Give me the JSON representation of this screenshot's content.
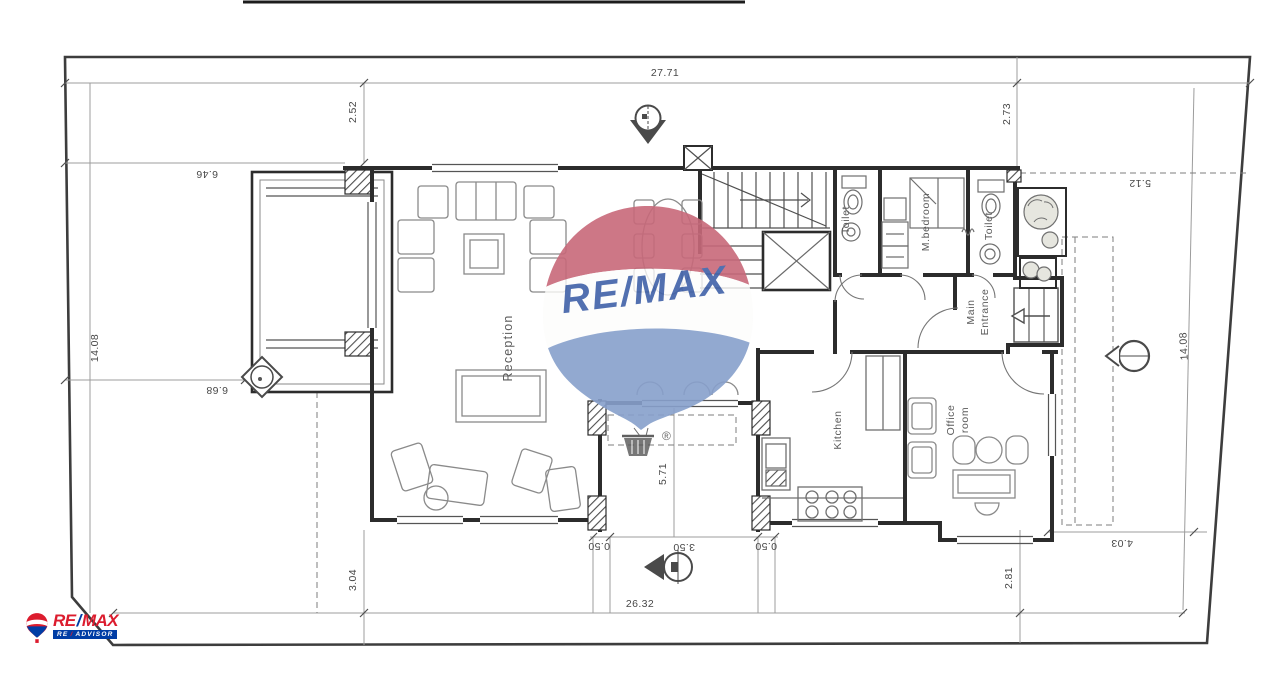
{
  "dim": {
    "top": "27.71",
    "bottom": "26.32",
    "left": "14.08",
    "right": "14.08",
    "tl": "2.52",
    "tr": "2.73",
    "lu": "6.46",
    "ll": "6.68",
    "bl": "3.04",
    "br": "2.81",
    "ru": "5.12",
    "rl": "4.03",
    "porch_depth": "5.71",
    "porch_width": "3.50",
    "porch_col_left": "0.50",
    "porch_col_right": "0.50"
  },
  "rooms": {
    "reception": "Reception",
    "toilet_a": "Toilet",
    "master_bedroom": "M.bedroom",
    "toilet_b": "Toilet",
    "main_entrance_line1": "Main",
    "main_entrance_line2": "Entrance",
    "kitchen": "Kitchen",
    "office_line1": "Office",
    "office_line2": "room"
  },
  "watermark": {
    "brand": "RE/MAX",
    "registered": "®"
  },
  "logo": {
    "re": "RE",
    "slash": "/",
    "max": "MAX",
    "bar_left": "RE",
    "bar_slash": "/",
    "bar_right": "ADVISOR"
  },
  "colors": {
    "balloon_red": "#c8697a",
    "balloon_blue": "#87a0cc",
    "watermark_text_blue": "#4061a8",
    "logo_red": "#dc1c2e",
    "logo_blue": "#003da5",
    "wall_dark": "#2c2c2c",
    "line_light": "#9c9c9c",
    "paper": "#ffffff"
  }
}
